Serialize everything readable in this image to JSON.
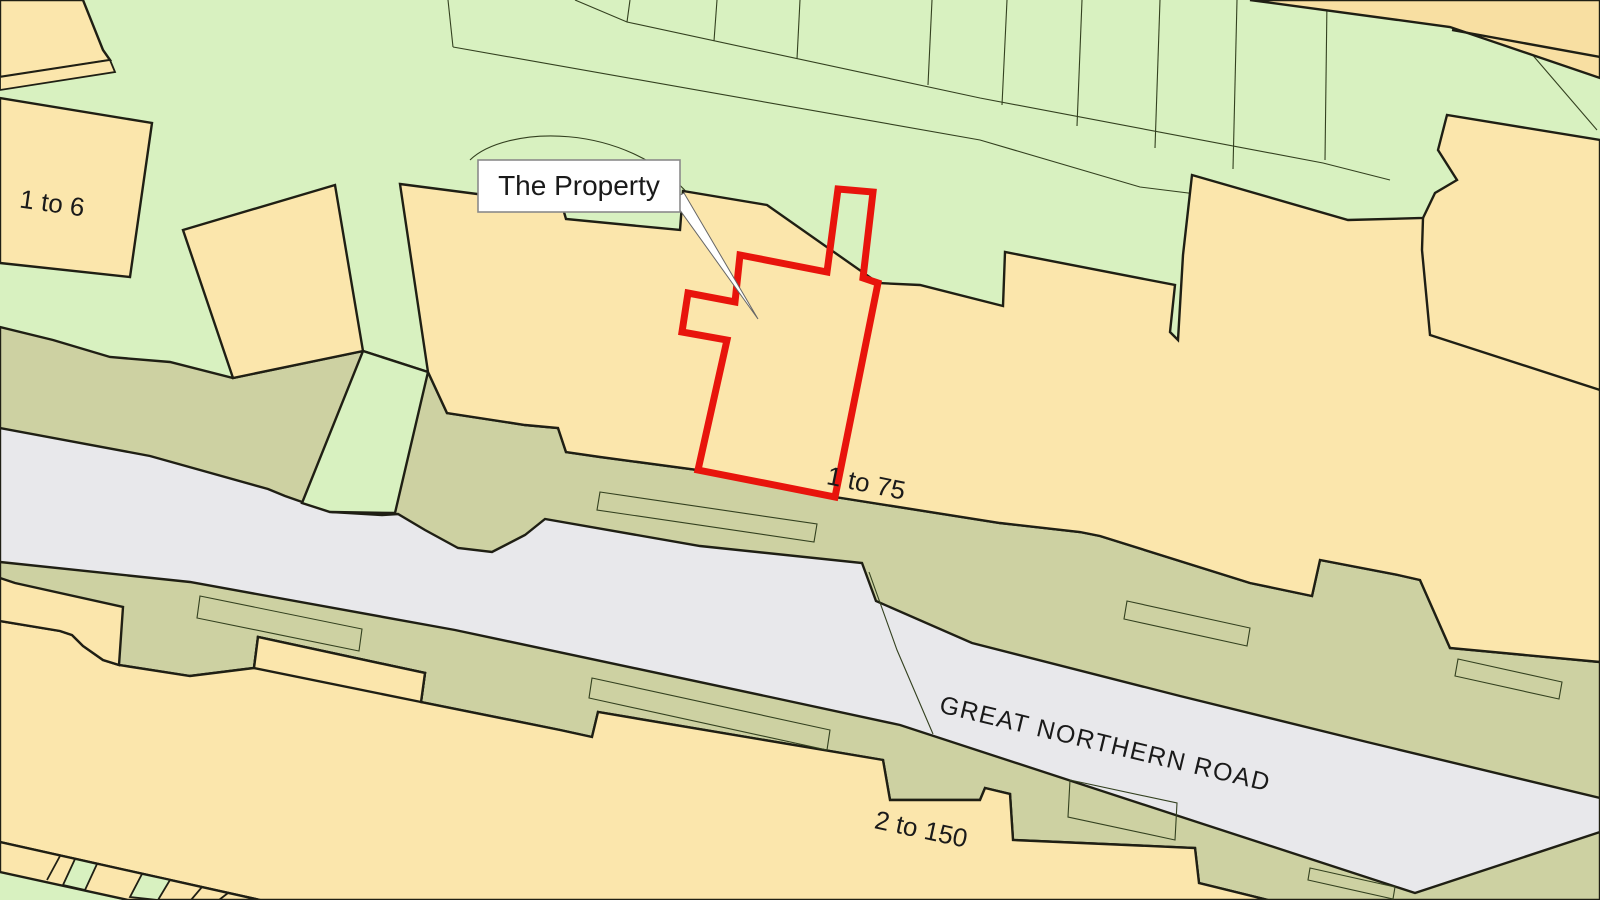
{
  "map": {
    "labels": {
      "callout": "The Property",
      "parcel_range_nw": "1 to 6",
      "building_range_north": "1 to 75",
      "road_name": "GREAT NORTHERN ROAD",
      "building_range_south": "2 to 150"
    },
    "colors": {
      "parcel_green": "#d8f1c0",
      "building_tan": "#fbe6ac",
      "building_tan_dark": "#f8dfa2",
      "verge_olive": "#cdd1a2",
      "road_grey": "#e8e8eb",
      "boundary_red": "#e8140c",
      "line_dark": "#1f1f14",
      "line_thin": "#33401f",
      "callout_bg": "#ffffff",
      "callout_border": "#8a8a8a",
      "text_color": "#1a1a1a"
    }
  }
}
